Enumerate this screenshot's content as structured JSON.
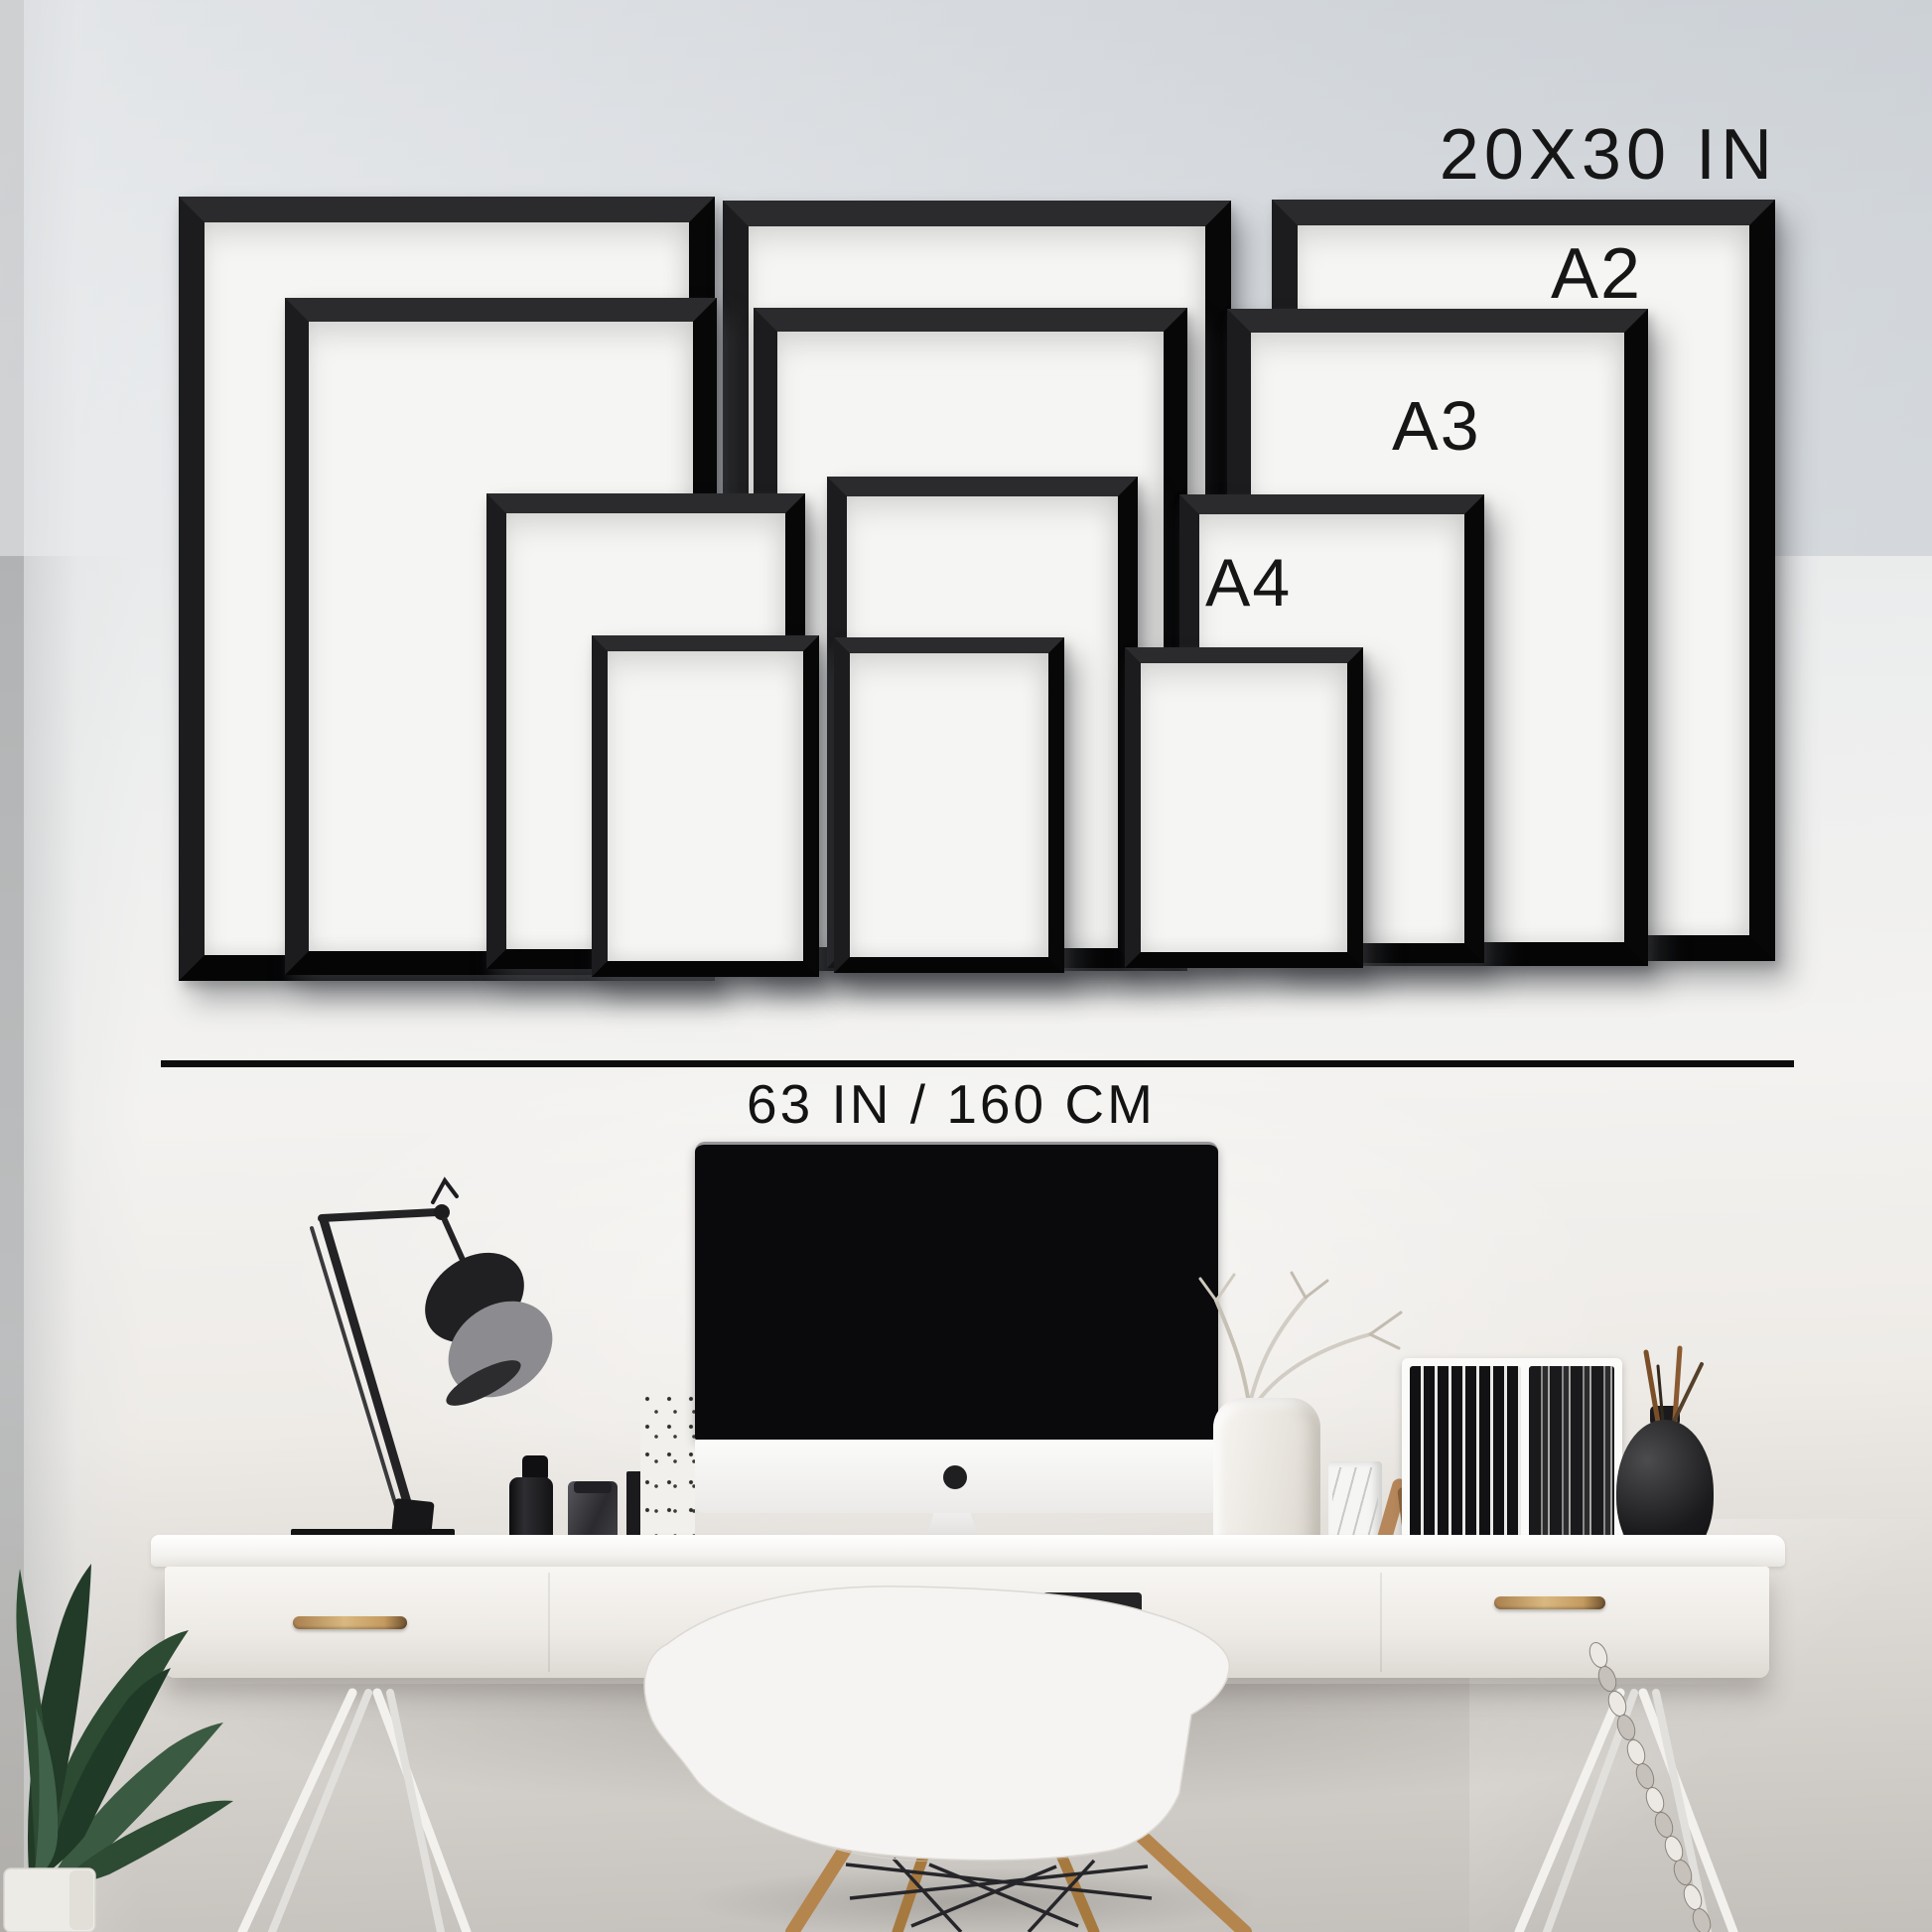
{
  "size_guide": {
    "top_size_label": "20X30 IN",
    "labels": {
      "a2": "A2",
      "a3": "A3",
      "a4": "A4"
    },
    "width_measurement_label": "63 IN / 160 CM",
    "frame_sizes_shown": [
      "20X30 IN",
      "A2",
      "A3",
      "A4"
    ],
    "frame_count": 12
  },
  "colors": {
    "frame_black": "#0d0d0e",
    "frame_mat": "#f5f5f3",
    "wall_light": "#efefee",
    "wall_top_gray": "#d6d9dd",
    "wall_bottom_taupe": "#c3bfba",
    "desk_white": "#f6f4f1",
    "handle_brass": "#c49a5f",
    "screen_black": "#0a0a0c",
    "plant_green": "#2d4a33",
    "wood_tan": "#b5854e"
  }
}
